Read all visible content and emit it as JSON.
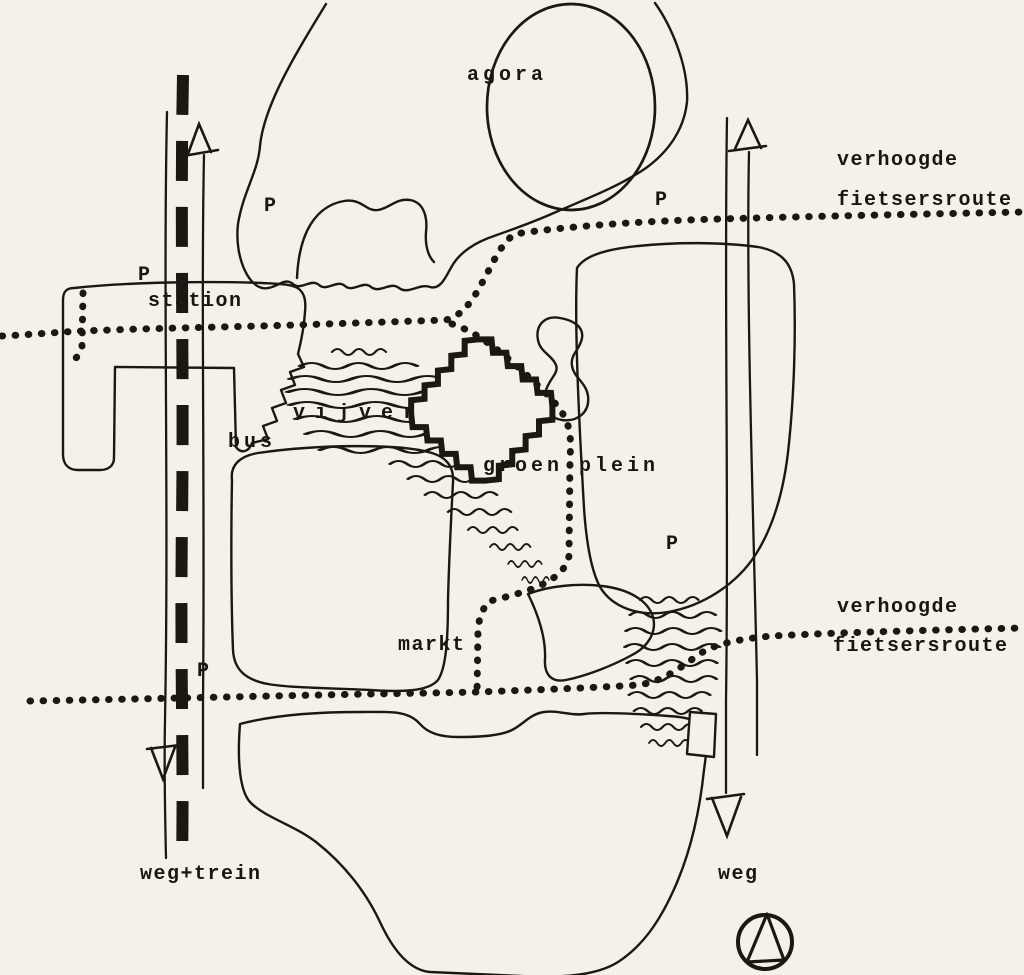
{
  "colors": {
    "paper": "#f5f1e9",
    "ink": "#1c1712"
  },
  "labels": {
    "agora": "agora",
    "parking": "P",
    "station": "station",
    "bus": "bus",
    "vijver": "vijver",
    "groen_plein": "groen plein",
    "markt": "markt",
    "verhoogde": "verhoogde",
    "fietsersroute": "fietsersroute",
    "weg_trein": "weg+trein",
    "weg": "weg"
  },
  "legend": {
    "routes": [
      {
        "name": "verhoogde fietsersroute",
        "style": "dotted line"
      },
      {
        "name": "weg+trein",
        "style": "double thin line with bold dashed rail"
      },
      {
        "name": "weg",
        "style": "double thin line with arrows"
      }
    ],
    "parking_symbol": "P",
    "parking_marker_count": 5,
    "compass": "north (circle with triangle)"
  }
}
